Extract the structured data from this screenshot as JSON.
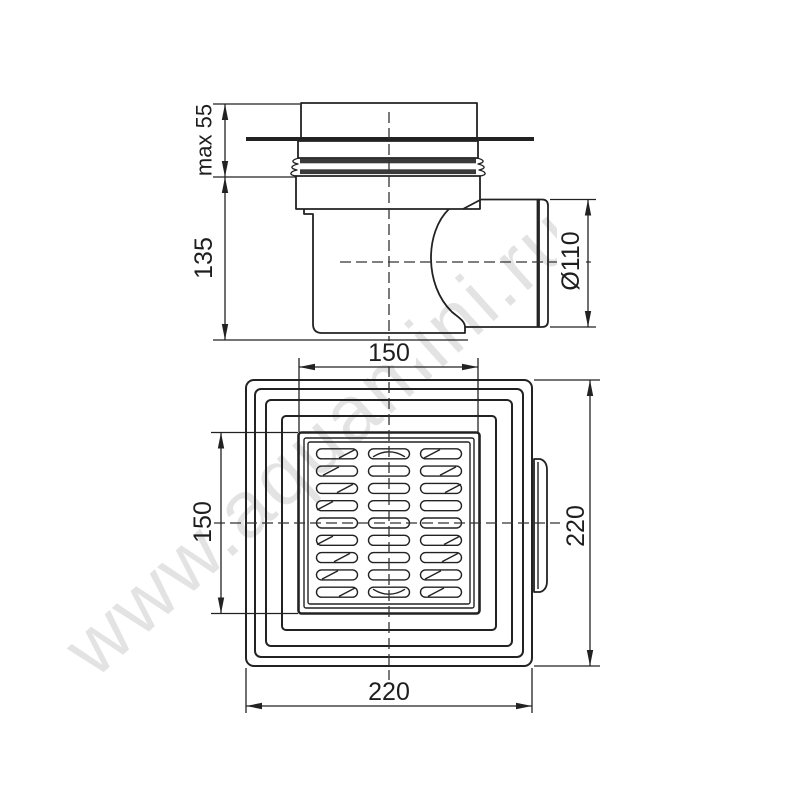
{
  "watermark": "www.aquamini.ru",
  "colors": {
    "line": "#222222",
    "rib_fill": "#3a3a3a",
    "watermark": "#dadada",
    "background": "#ffffff"
  },
  "side_view": {
    "dim_installation_height": "max 55",
    "dim_body_height": "135",
    "dim_outlet_diameter": "Ø110",
    "dim_body_width": "150"
  },
  "plan_view": {
    "dim_grate_height": "150",
    "dim_overall_height": "220",
    "dim_overall_width": "220"
  }
}
